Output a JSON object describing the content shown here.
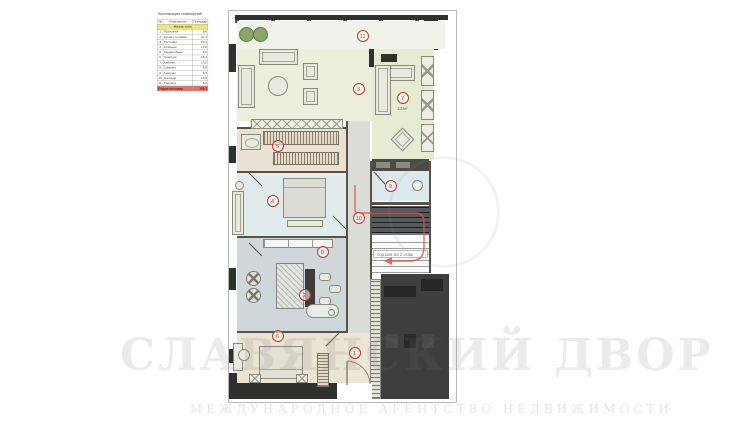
{
  "watermark": {
    "title": "СЛАВЯНСКИЙ ДВОР",
    "subtitle": "МЕЖДУНАРОДНОЕ АГЕНТСТВО НЕДВИЖИМОСТИ"
  },
  "legend": {
    "title": "Экспликация помещений",
    "columns": [
      "№",
      "Помещение",
      "Площадь"
    ],
    "zone_label": "Жилая зона",
    "rows": [
      {
        "num": "1",
        "name": "Прихожая",
        "area": "9,6"
      },
      {
        "num": "2",
        "name": "Кухня-столовая",
        "area": "22,1"
      },
      {
        "num": "3",
        "name": "Гостиная",
        "area": "23,4"
      },
      {
        "num": "4",
        "name": "Спальня",
        "area": "17,8"
      },
      {
        "num": "5",
        "name": "Гардеробная",
        "area": "8,6"
      },
      {
        "num": "6",
        "name": "Спальня",
        "area": "16,4"
      },
      {
        "num": "7",
        "name": "Кабинет",
        "area": "13,0"
      },
      {
        "num": "8",
        "name": "Санузел",
        "area": "5,8"
      },
      {
        "num": "9",
        "name": "Санузел",
        "area": "4,1"
      },
      {
        "num": "10",
        "name": "Коридор",
        "area": "10,9"
      },
      {
        "num": "11",
        "name": "Терраса",
        "area": "8,2"
      }
    ],
    "total": {
      "label": "Общая площадь",
      "value": "163,1"
    }
  },
  "plan": {
    "area_label": "13 м²",
    "stairs_label": "подъем на 2 этаж",
    "markers": [
      {
        "label": "11",
        "x": 134,
        "y": 25
      },
      {
        "label": "3",
        "x": 130,
        "y": 78
      },
      {
        "label": "7",
        "x": 174,
        "y": 87
      },
      {
        "label": "5",
        "x": 49,
        "y": 135
      },
      {
        "label": "4",
        "x": 44,
        "y": 190
      },
      {
        "label": "9",
        "x": 162,
        "y": 175
      },
      {
        "label": "10",
        "x": 130,
        "y": 207
      },
      {
        "label": "8",
        "x": 94,
        "y": 241
      },
      {
        "label": "2",
        "x": 76,
        "y": 284
      },
      {
        "label": "6",
        "x": 49,
        "y": 325
      },
      {
        "label": "1",
        "x": 126,
        "y": 342
      }
    ],
    "colors": {
      "marker_red": "#c0392b",
      "route_red": "#d9534f",
      "wall_dark": "#30302e",
      "zone_yellow": "#f1e47c",
      "total_red": "#e57368"
    }
  }
}
